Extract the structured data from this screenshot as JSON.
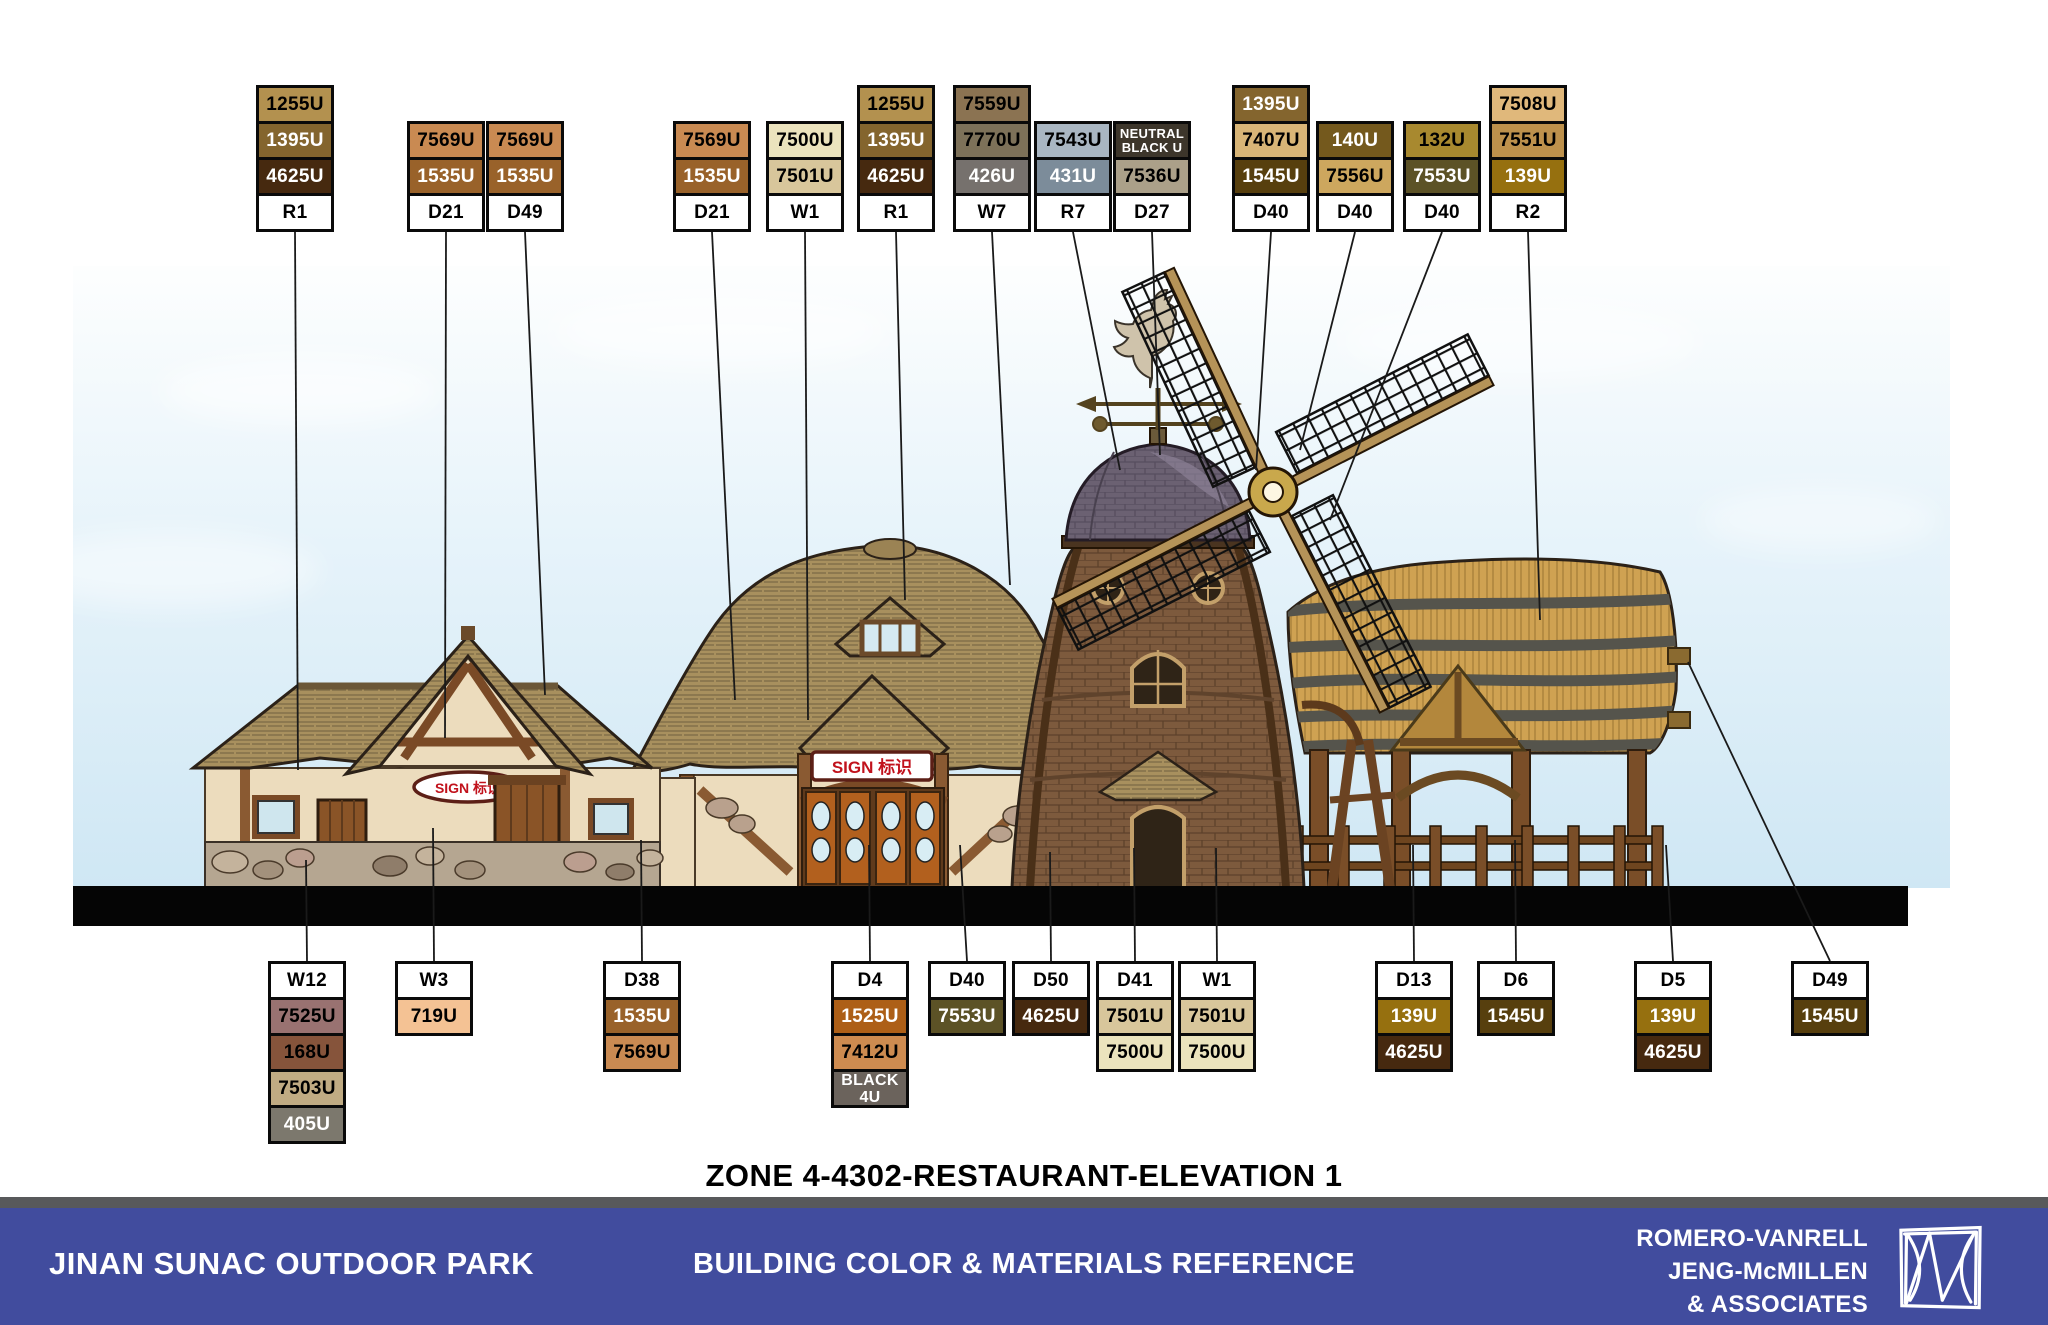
{
  "title": "ZONE 4-4302-RESTAURANT-ELEVATION 1",
  "footer": {
    "left": "JINAN SUNAC OUTDOOR PARK",
    "center": "BUILDING COLOR & MATERIALS REFERENCE",
    "right_line1": "ROMERO-VANRELL",
    "right_line2": "JENG-McMILLEN",
    "right_line3": "& ASSOCIATES",
    "bar_color": "#414c9e",
    "divider_color": "#58595b"
  },
  "signs": {
    "left_building": "SIGN 标识",
    "center_building": "SIGN 标识"
  },
  "palette": {
    "1255U": {
      "hex": "#b3914f",
      "text": "#000000"
    },
    "1395U": {
      "hex": "#84652e",
      "text": "#ffffff"
    },
    "4625U": {
      "hex": "#46290f",
      "text": "#ffffff"
    },
    "7569U": {
      "hex": "#c98a52",
      "text": "#000000"
    },
    "1535U": {
      "hex": "#99622a",
      "text": "#ffffff"
    },
    "7500U": {
      "hex": "#ebe3bd",
      "text": "#000000"
    },
    "7501U": {
      "hex": "#d8c69b",
      "text": "#000000"
    },
    "7559U": {
      "hex": "#8b7352",
      "text": "#000000"
    },
    "7770U": {
      "hex": "#7d7159",
      "text": "#000000"
    },
    "426U": {
      "hex": "#76716d",
      "text": "#ffffff"
    },
    "7543U": {
      "hex": "#a9b6c2",
      "text": "#000000"
    },
    "431U": {
      "hex": "#7c8c9a",
      "text": "#ffffff"
    },
    "NEUTRAL BLACK U": {
      "hex": "#3d362b",
      "text": "#ffffff"
    },
    "7536U": {
      "hex": "#aba089",
      "text": "#000000"
    },
    "7407U": {
      "hex": "#d8b577",
      "text": "#000000"
    },
    "1545U": {
      "hex": "#573f0e",
      "text": "#ffffff"
    },
    "140U": {
      "hex": "#74591d",
      "text": "#ffffff"
    },
    "7556U": {
      "hex": "#cda75e",
      "text": "#000000"
    },
    "132U": {
      "hex": "#a8892f",
      "text": "#000000"
    },
    "7553U": {
      "hex": "#5c5226",
      "text": "#ffffff"
    },
    "7508U": {
      "hex": "#e0b87b",
      "text": "#000000"
    },
    "7551U": {
      "hex": "#bd914c",
      "text": "#000000"
    },
    "139U": {
      "hex": "#96700f",
      "text": "#ffffff"
    },
    "7525U": {
      "hex": "#997271",
      "text": "#000000"
    },
    "168U": {
      "hex": "#86543b",
      "text": "#000000"
    },
    "7503U": {
      "hex": "#c0ab83",
      "text": "#000000"
    },
    "405U": {
      "hex": "#7c786d",
      "text": "#ffffff"
    },
    "719U": {
      "hex": "#f4c294",
      "text": "#000000"
    },
    "1525U": {
      "hex": "#ad5f17",
      "text": "#ffffff"
    },
    "7412U": {
      "hex": "#cd8b50",
      "text": "#000000"
    },
    "BLACK 4U": {
      "hex": "#6b635c",
      "text": "#ffffff"
    }
  },
  "callouts": {
    "top": [
      {
        "code": "R1",
        "chips": [
          "1255U",
          "1395U",
          "4625U"
        ],
        "x": 256
      },
      {
        "code": "D21",
        "chips": [
          "7569U",
          "1535U"
        ],
        "x": 407
      },
      {
        "code": "D49",
        "chips": [
          "7569U",
          "1535U"
        ],
        "x": 486
      },
      {
        "code": "D21",
        "chips": [
          "7569U",
          "1535U"
        ],
        "x": 673
      },
      {
        "code": "W1",
        "chips": [
          "7500U",
          "7501U"
        ],
        "x": 766
      },
      {
        "code": "R1",
        "chips": [
          "1255U",
          "1395U",
          "4625U"
        ],
        "x": 857
      },
      {
        "code": "W7",
        "chips": [
          "7559U",
          "7770U",
          "426U"
        ],
        "x": 953
      },
      {
        "code": "R7",
        "chips": [
          "7543U",
          "431U"
        ],
        "x": 1034
      },
      {
        "code": "D27",
        "chips": [
          "NEUTRAL BLACK U",
          "7536U"
        ],
        "x": 1113
      },
      {
        "code": "D40",
        "chips": [
          "1395U",
          "7407U",
          "1545U"
        ],
        "x": 1232
      },
      {
        "code": "D40",
        "chips": [
          "140U",
          "7556U"
        ],
        "x": 1316
      },
      {
        "code": "D40",
        "chips": [
          "132U",
          "7553U"
        ],
        "x": 1403
      },
      {
        "code": "R2",
        "chips": [
          "7508U",
          "7551U",
          "139U"
        ],
        "x": 1489
      }
    ],
    "bottom": [
      {
        "code": "W12",
        "chips": [
          "7525U",
          "168U",
          "7503U",
          "405U"
        ],
        "x": 268
      },
      {
        "code": "W3",
        "chips": [
          "719U"
        ],
        "x": 395
      },
      {
        "code": "D38",
        "chips": [
          "1535U",
          "7569U"
        ],
        "x": 603
      },
      {
        "code": "D4",
        "chips": [
          "1525U",
          "7412U",
          "BLACK 4U"
        ],
        "x": 831
      },
      {
        "code": "D40",
        "chips": [
          "7553U"
        ],
        "x": 928
      },
      {
        "code": "D50",
        "chips": [
          "4625U"
        ],
        "x": 1012
      },
      {
        "code": "D41",
        "chips": [
          "7501U",
          "7500U"
        ],
        "x": 1096
      },
      {
        "code": "W1",
        "chips": [
          "7501U",
          "7500U"
        ],
        "x": 1178
      },
      {
        "code": "D13",
        "chips": [
          "139U",
          "4625U"
        ],
        "x": 1375
      },
      {
        "code": "D6",
        "chips": [
          "1545U"
        ],
        "x": 1477
      },
      {
        "code": "D5",
        "chips": [
          "139U",
          "4625U"
        ],
        "x": 1634
      },
      {
        "code": "D49",
        "chips": [
          "1545U"
        ],
        "x": 1791
      }
    ]
  }
}
